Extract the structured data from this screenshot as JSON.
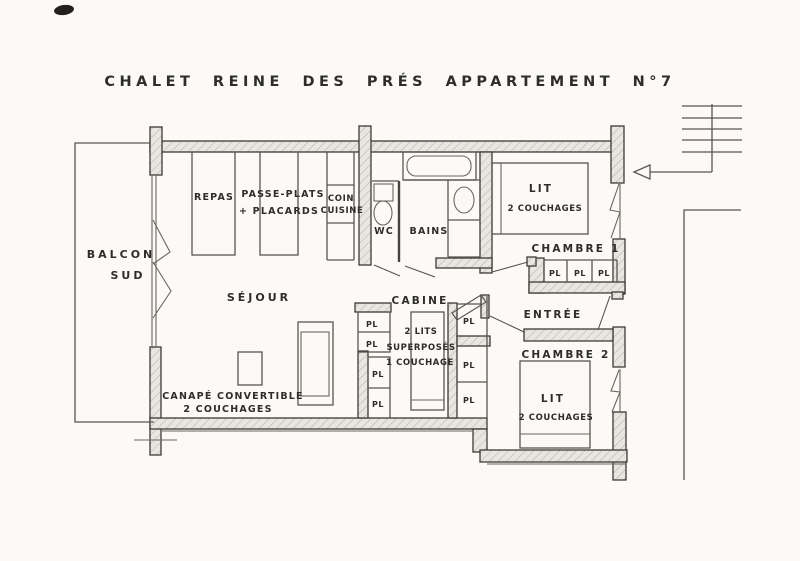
{
  "title": "CHALET REINE DES PRÉS APPARTEMENT N°7",
  "rooms": {
    "balcon": {
      "line1": "BALCON",
      "line2": "SUD"
    },
    "sejour": "SÉJOUR",
    "repas": "REPAS",
    "passe_plats": {
      "line1": "PASSE-PLATS",
      "line2": "+ PLACARDS"
    },
    "coin_cuisine": {
      "line1": "COIN",
      "line2": "CUISINE"
    },
    "wc": "WC",
    "bains": "BAINS",
    "cabine": "CABINE",
    "entree": "ENTRÉE",
    "chambre1": "CHAMBRE 1",
    "chambre2": "CHAMBRE 2"
  },
  "furniture": {
    "lit_chambre1": {
      "line1": "LIT",
      "line2": "2 COUCHAGES"
    },
    "lit_chambre2": {
      "line1": "LIT",
      "line2": "2 COUCHAGES"
    },
    "canape": {
      "line1": "CANAPÉ CONVERTIBLE",
      "line2": "2 COUCHAGES"
    },
    "lits_superposes": {
      "line1": "2 LITS",
      "line2": "SUPERPOSÉS",
      "line3": "1 COUCHAGE"
    },
    "placard": "PL"
  },
  "colors": {
    "paper": "#fbfaf7",
    "ink": "#2e2d2b",
    "wall_fill": "#e8e6e1",
    "wall_hatch": "#b7b2a8"
  }
}
